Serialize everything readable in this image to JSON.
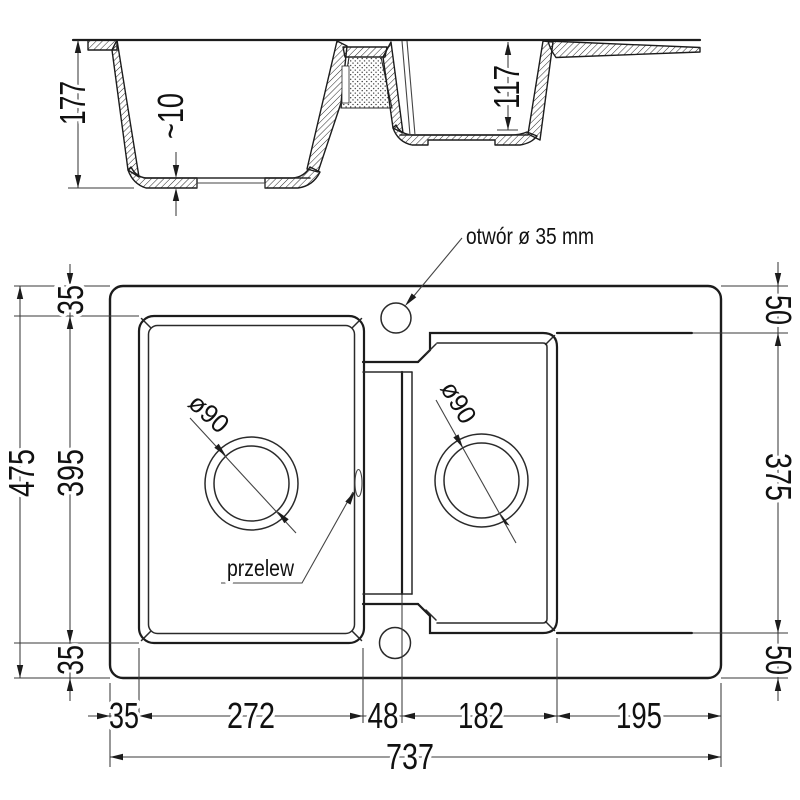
{
  "drawing": {
    "type": "sink-technical-drawing",
    "line_color": "#1c1c1c",
    "background": "#ffffff",
    "section": {
      "overall_depth": "177",
      "bottom_thickness": "~10",
      "small_bowl_depth": "117"
    },
    "plan": {
      "tap_hole_label": "otwór ø 35 mm",
      "overflow_label": "przelew",
      "main_drain_diameter": "ø90",
      "small_drain_diameter": "ø90",
      "left": {
        "overall_height": "475",
        "main_bowl_height": "395",
        "top_margin": "35",
        "bottom_margin": "35"
      },
      "right": {
        "top_margin": "50",
        "right_section_height": "375",
        "bottom_margin": "50"
      },
      "bottom": {
        "left_margin": "35",
        "main_bowl_width": "272",
        "divider_width": "48",
        "small_bowl_width": "182",
        "drainer_width": "195",
        "overall_width": "737"
      }
    }
  }
}
